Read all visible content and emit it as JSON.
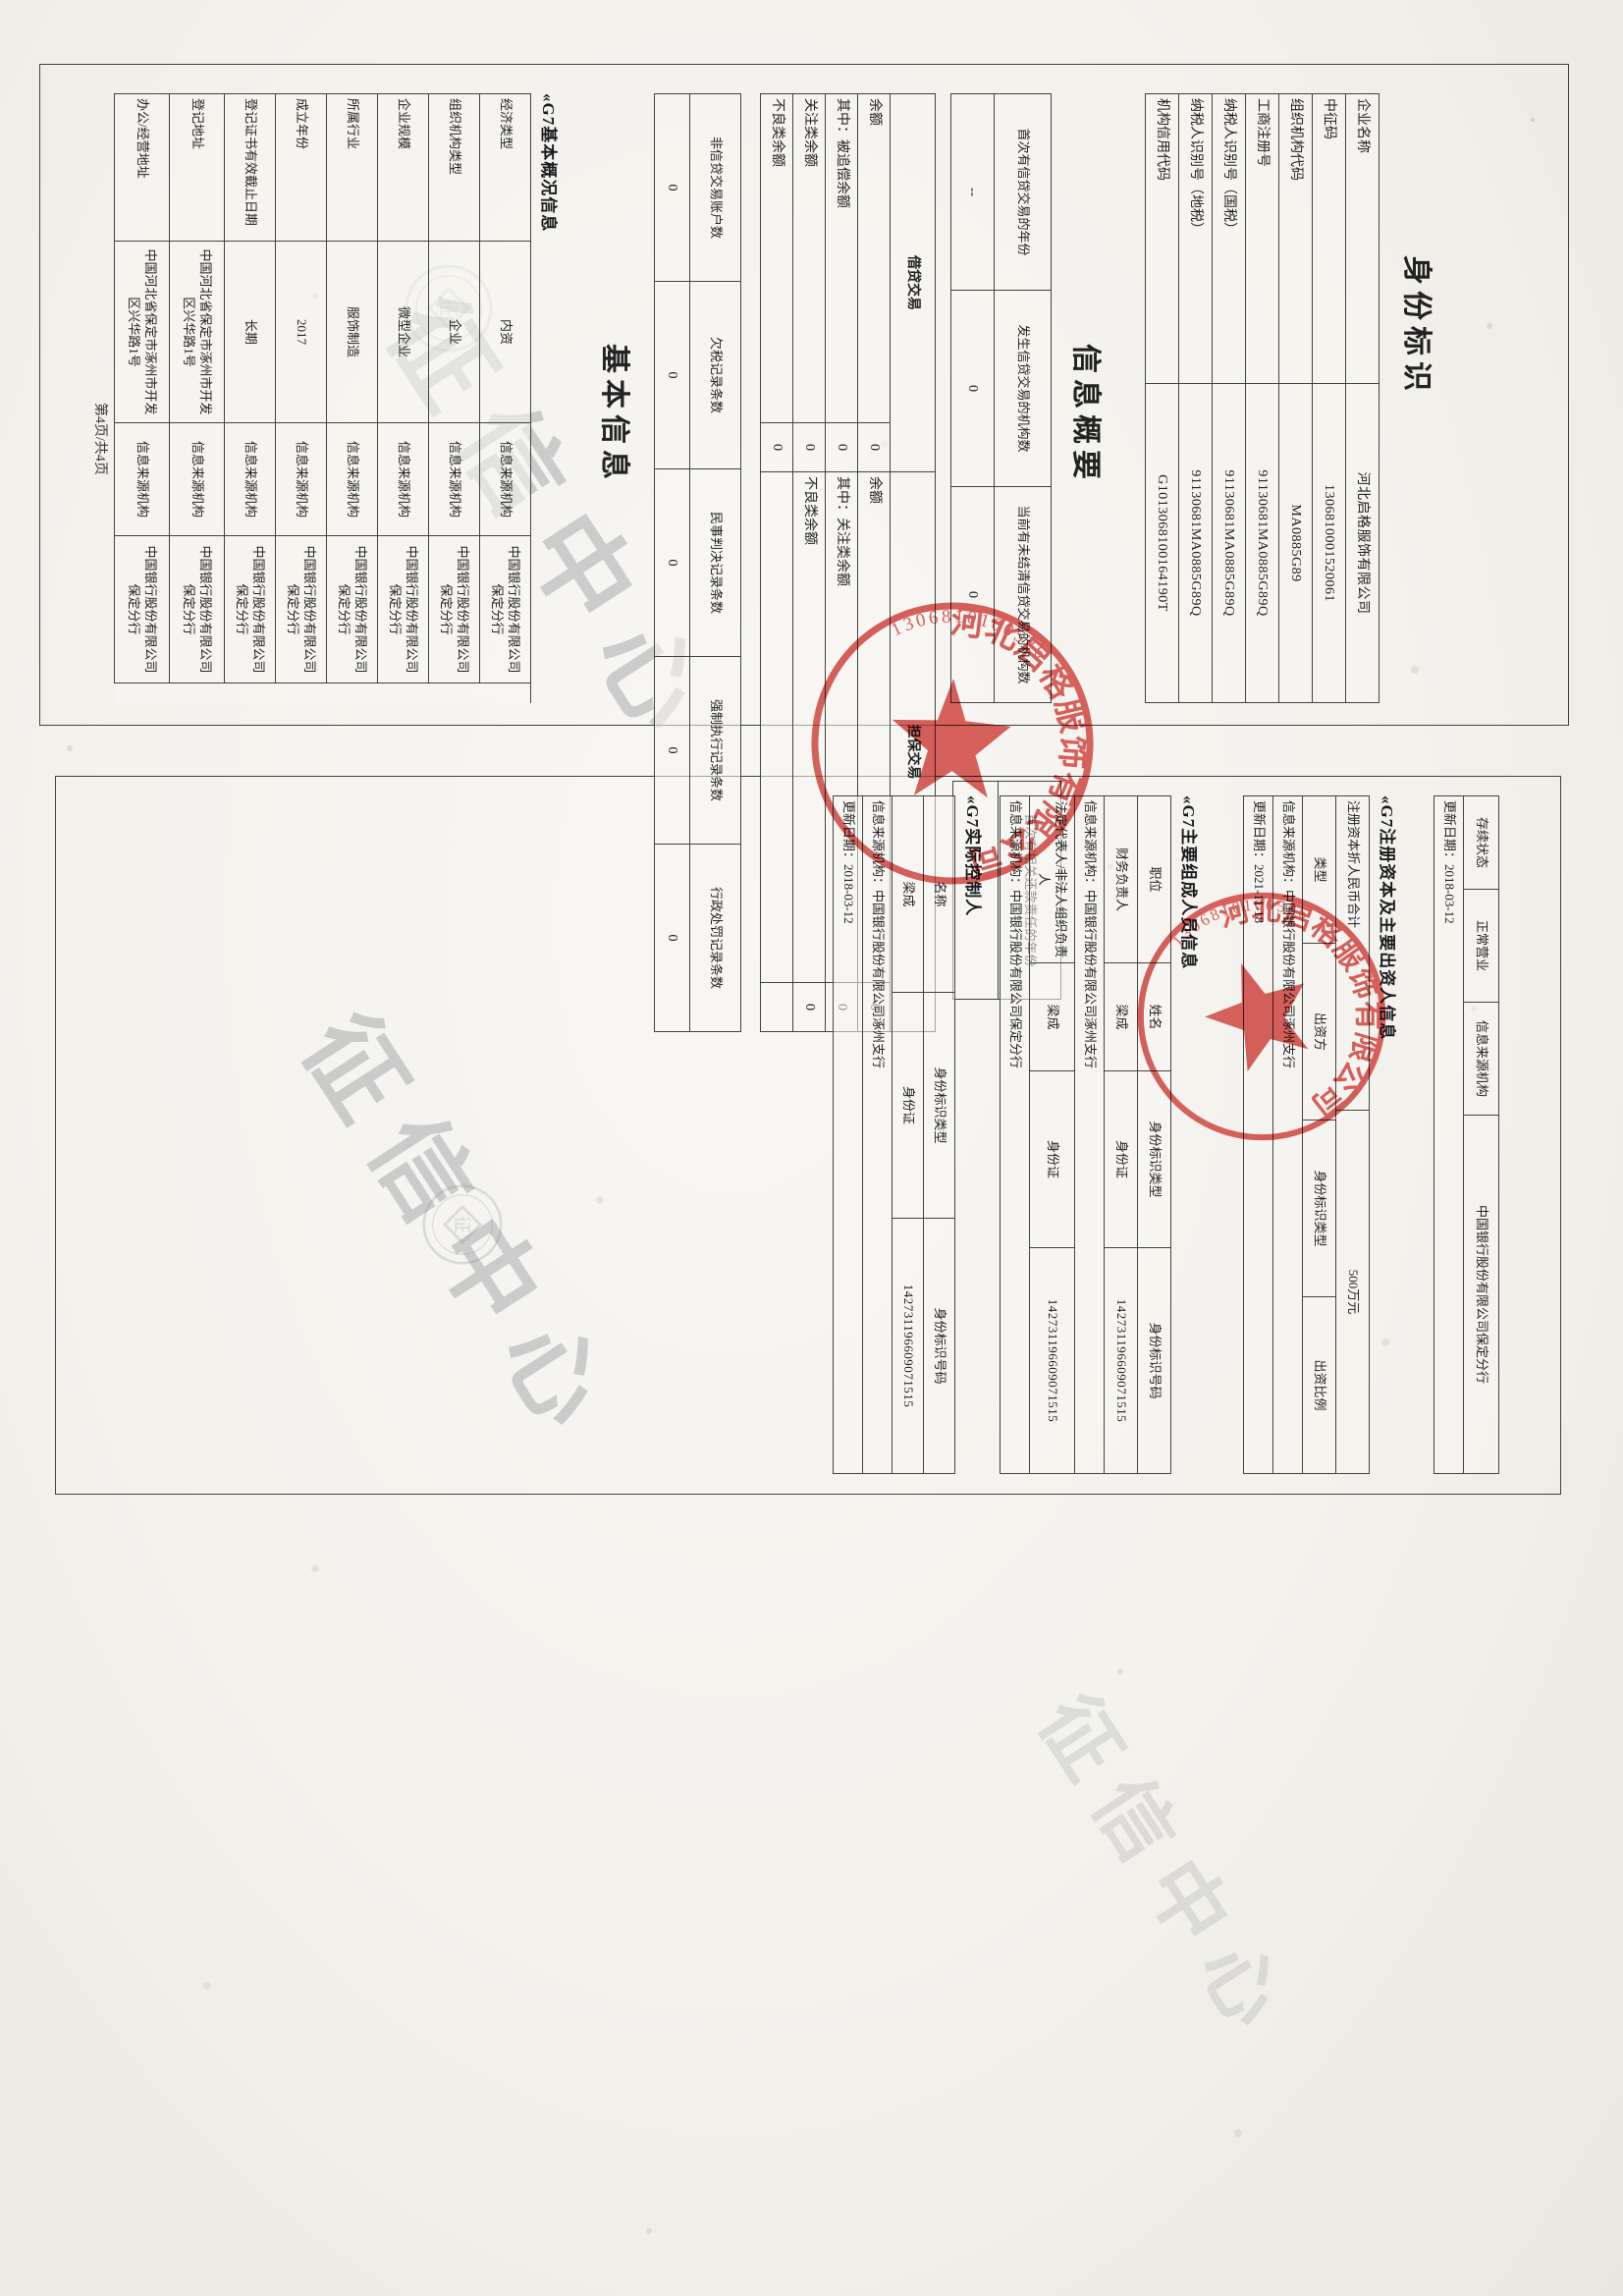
{
  "page": {
    "footer": "第4页/共4页",
    "watermark_text": "征信中心",
    "watermark_logo_char": "征"
  },
  "titles": {
    "identity": "身份标识",
    "summary": "信息概要",
    "basic": "基本信息",
    "basic_sub": "«G7基本概况信息",
    "capital_sub": "«G7注册资本及主要出资人信息",
    "members_sub": "«G7主要组成人员信息",
    "controller_sub": "«G7实际控制人"
  },
  "identity_table": {
    "rows": [
      {
        "label": "企业名称",
        "value": "河北启格服饰有限公司"
      },
      {
        "label": "中征码",
        "value": "1306810001520061"
      },
      {
        "label": "组织机构代码",
        "value": "MA0885G89"
      },
      {
        "label": "工商注册号",
        "value": "91130681MA0885G89Q"
      },
      {
        "label": "纳税人识别号（国税）",
        "value": "91130681MA0885G89Q"
      },
      {
        "label": "纳税人识别号（地税）",
        "value": "91130681MA0885G89Q"
      },
      {
        "label": "机构信用代码",
        "value": "G1013068100164190T"
      }
    ]
  },
  "summary1": {
    "h1": "首次有信贷交易的年份",
    "v1": "--",
    "h2": "发生信贷交易的机构数",
    "v2": "0",
    "h3": "当前有未结清信贷交易的机构数",
    "v3": "0"
  },
  "summary1b": {
    "header": "首次有相关还款责任的年份",
    "value": "--"
  },
  "credit": {
    "left_header": "借贷交易",
    "right_header": "担保交易",
    "r1l": "余额",
    "r1lv": "0",
    "r1r": "余额",
    "r1rv": "0",
    "r2l": "其中：被追偿余额",
    "r2lv": "0",
    "r2r": "其中：关注类余额",
    "r2rv": "0",
    "r3l": "关注类余额",
    "r3lv": "0",
    "r3r": "不良类余额",
    "r3rv": "0",
    "r4l": "不良类余额",
    "r4lv": "0"
  },
  "noncredit": {
    "h1": "非信贷交易账户数",
    "h2": "欠税记录条数",
    "h3": "民事判决记录条数",
    "h4": "强制执行记录条数",
    "h5": "行政处罚记录条数",
    "v1": "0",
    "v2": "0",
    "v3": "0",
    "v4": "0",
    "v5": "0"
  },
  "basic_table": {
    "source_label": "信息来源机构",
    "source_org": "中国银行股份有限公司保定分行",
    "rows": [
      {
        "label": "经济类型",
        "value": "内资"
      },
      {
        "label": "组织机构类型",
        "value": "企业"
      },
      {
        "label": "企业规模",
        "value": "微型企业"
      },
      {
        "label": "所属行业",
        "value": "服饰制造"
      },
      {
        "label": "成立年份",
        "value": "2017"
      },
      {
        "label": "登记证书有效截止日期",
        "value": "长期"
      },
      {
        "label": "登记地址",
        "value": "中国河北省保定市涿州市开发区兴华路1号"
      },
      {
        "label": "办公/经营地址",
        "value": "中国河北省保定市涿州市开发区兴华路1号"
      }
    ]
  },
  "right": {
    "status": {
      "label": "存续状态",
      "value": "正常营业",
      "source_label": "信息来源机构",
      "source_org": "中国银行股份有限公司保定分行"
    },
    "status_updated": "更新日期：2018-03-12",
    "capital": {
      "label": "注册资本折人民币合计",
      "value": "500万元",
      "h1": "类型",
      "h2": "出资方",
      "h3": "身份标识类型",
      "h4": "出资比例",
      "source": "信息来源机构：中国银行股份有限公司涿州支行",
      "updated": "更新日期：2021-11-18"
    },
    "members": {
      "h1": "职位",
      "h2": "姓名",
      "h3": "身份标识类型",
      "h4": "身份标识号码",
      "row1": {
        "position": "财务负责人",
        "name": "梁成",
        "id_type": "身份证",
        "id_no": "142731196609071515"
      },
      "row2": {
        "position": "法定代表人/非法人组织负责人",
        "name": "梁成",
        "id_type": "身份证",
        "id_no": "142731196609071515"
      },
      "source1": "信息来源机构：中国银行股份有限公司涿州支行",
      "source2": "信息来源机构：中国银行股份有限公司保定分行"
    },
    "controller": {
      "h1": "名称",
      "h2": "身份标识类型",
      "h3": "身份标识号码",
      "name": "梁成",
      "id_type": "身份证",
      "id_no": "142731196609071515",
      "source": "信息来源机构：中国银行股份有限公司涿州支行",
      "updated": "更新日期：2018-03-12"
    }
  },
  "stamps": {
    "ring_text": "河北启格服饰有限公司",
    "code": "1306810100526"
  }
}
